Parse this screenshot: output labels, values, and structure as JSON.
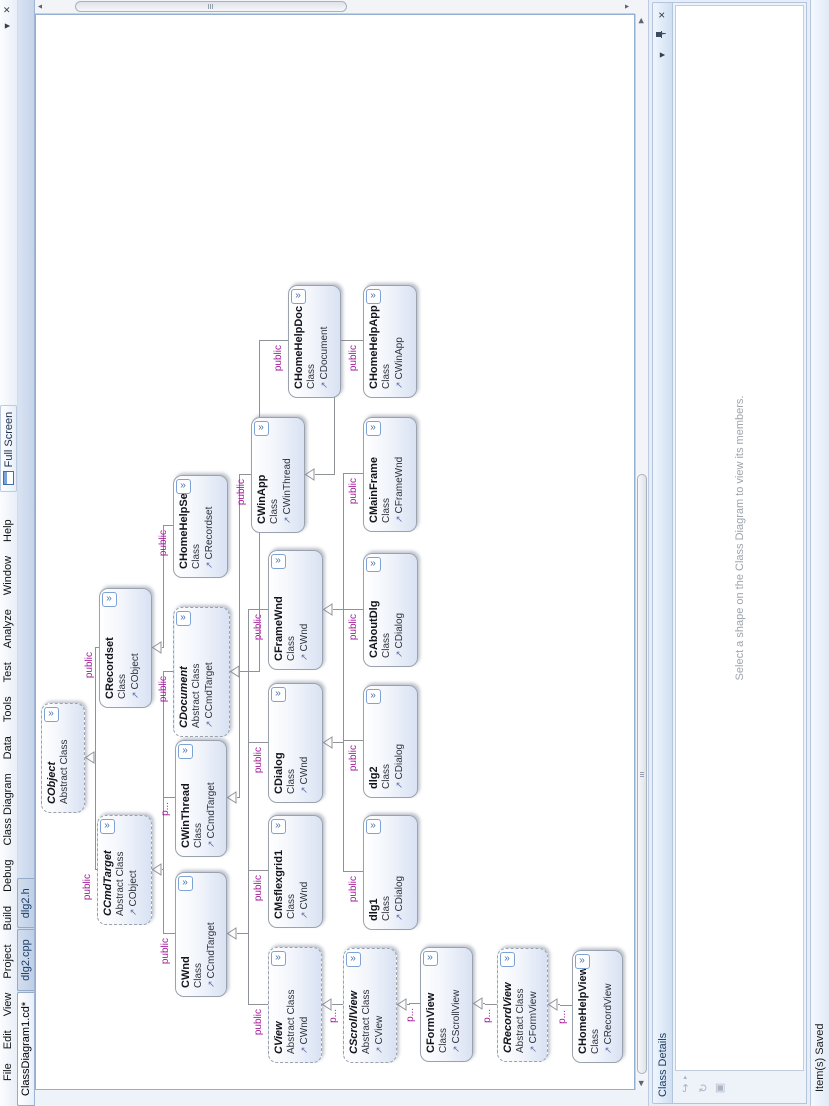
{
  "window": {
    "menu_items": [
      "File",
      "Edit",
      "View",
      "Project",
      "Build",
      "Debug",
      "Class Diagram",
      "Data",
      "Tools",
      "Test",
      "Analyze",
      "Window",
      "Help"
    ],
    "full_screen_button": "Full Screen",
    "tabs": [
      {
        "label": "ClassDiagram1.cd*",
        "active": true
      },
      {
        "label": "dlg2.cpp",
        "active": false
      },
      {
        "label": "dlg2.h",
        "active": false
      }
    ],
    "tab_bar_icons": {
      "file_list_dropdown": "▼",
      "close_document": "✕"
    }
  },
  "diagram": {
    "expand_chevron": "»",
    "base_arrow": "↗",
    "classes": [
      {
        "name": "CObject",
        "kind": "Abstract Class",
        "abstract": true,
        "base": null,
        "access": null,
        "x": 293,
        "y": 41,
        "w": 110,
        "h": 44
      },
      {
        "name": "CCmdTarget",
        "kind": "Abstract Class",
        "abstract": true,
        "base": "CObject",
        "access": "public",
        "x": 181,
        "y": 97,
        "w": 110,
        "h": 55
      },
      {
        "name": "CRecordset",
        "kind": "Class",
        "abstract": false,
        "base": "CObject",
        "access": "public",
        "x": 398,
        "y": 99,
        "w": 120,
        "h": 53
      },
      {
        "name": "CWnd",
        "kind": "Class",
        "abstract": false,
        "base": "CCmdTarget",
        "access": "public",
        "x": 109,
        "y": 175,
        "w": 125,
        "h": 52
      },
      {
        "name": "CWinThread",
        "kind": "Class",
        "abstract": false,
        "base": "CCmdTarget",
        "access": "p...",
        "x": 249,
        "y": 175,
        "w": 117,
        "h": 52
      },
      {
        "name": "CDocument",
        "kind": "Abstract Class",
        "abstract": true,
        "base": "CCmdTarget",
        "access": "public",
        "x": 369,
        "y": 173,
        "w": 130,
        "h": 57
      },
      {
        "name": "CHomeHelpSet",
        "kind": "Class",
        "abstract": false,
        "base": "CRecordset",
        "access": "public",
        "x": 528,
        "y": 173,
        "w": 103,
        "h": 55
      },
      {
        "name": "CView",
        "kind": "Abstract Class",
        "abstract": true,
        "base": "CWnd",
        "access": "public",
        "x": 43,
        "y": 268,
        "w": 116,
        "h": 54
      },
      {
        "name": "CMsflexgrid1",
        "kind": "Class",
        "abstract": false,
        "base": "CWnd",
        "access": "public",
        "x": 178,
        "y": 268,
        "w": 113,
        "h": 55
      },
      {
        "name": "CDialog",
        "kind": "Class",
        "abstract": false,
        "base": "CWnd",
        "access": "public",
        "x": 303,
        "y": 268,
        "w": 120,
        "h": 55
      },
      {
        "name": "CFrameWnd",
        "kind": "Class",
        "abstract": false,
        "base": "CWnd",
        "access": "public",
        "x": 436,
        "y": 268,
        "w": 120,
        "h": 55
      },
      {
        "name": "CWinApp",
        "kind": "Class",
        "abstract": false,
        "base": "CWinThread",
        "access": "public",
        "x": 573,
        "y": 251,
        "w": 116,
        "h": 54
      },
      {
        "name": "CHomeHelpDoc",
        "kind": "Class",
        "abstract": false,
        "base": "CDocument",
        "access": "public",
        "x": 708,
        "y": 288,
        "w": 113,
        "h": 53
      },
      {
        "name": "CScrollView",
        "kind": "Abstract Class",
        "abstract": true,
        "base": "CView",
        "access": "p...",
        "x": 43,
        "y": 343,
        "w": 115,
        "h": 54
      },
      {
        "name": "dlg1",
        "kind": "Class",
        "abstract": false,
        "base": "CDialog",
        "access": "public",
        "x": 176,
        "y": 363,
        "w": 115,
        "h": 55
      },
      {
        "name": "dlg2",
        "kind": "Class",
        "abstract": false,
        "base": "CDialog",
        "access": "public",
        "x": 308,
        "y": 363,
        "w": 113,
        "h": 55
      },
      {
        "name": "CAboutDlg",
        "kind": "Class",
        "abstract": false,
        "base": "CDialog",
        "access": "public",
        "x": 439,
        "y": 363,
        "w": 114,
        "h": 55
      },
      {
        "name": "CMainFrame",
        "kind": "Class",
        "abstract": false,
        "base": "CFrameWnd",
        "access": "public",
        "x": 574,
        "y": 363,
        "w": 115,
        "h": 54
      },
      {
        "name": "CHomeHelpApp",
        "kind": "Class",
        "abstract": false,
        "base": "CWinApp",
        "access": "public",
        "x": 708,
        "y": 363,
        "w": 113,
        "h": 54
      },
      {
        "name": "CFormView",
        "kind": "Class",
        "abstract": false,
        "base": "CScrollView",
        "access": "p...",
        "x": 44,
        "y": 420,
        "w": 115,
        "h": 53
      },
      {
        "name": "CRecordView",
        "kind": "Abstract Class",
        "abstract": true,
        "base": "CFormView",
        "access": "p...",
        "x": 44,
        "y": 497,
        "w": 114,
        "h": 51
      },
      {
        "name": "CHomeHelpView",
        "kind": "Class",
        "abstract": false,
        "base": "CRecordView",
        "access": "p...",
        "x": 43,
        "y": 572,
        "w": 113,
        "h": 51
      }
    ]
  },
  "class_details": {
    "title": "Class Details",
    "hint": "Select a shape on the Class Diagram to view its members.",
    "buttons": {
      "window_position": "▼",
      "close": "✕"
    },
    "toolbar_icons": [
      "↪",
      "↻",
      "▣"
    ]
  },
  "status": {
    "text": "Item(s) Saved"
  },
  "colors": {
    "access_label": "#A21899",
    "box_gradient_bottom": "#D9E2F3",
    "chrome": "#DCE6F4",
    "canvas_border": "#95AFD2"
  }
}
